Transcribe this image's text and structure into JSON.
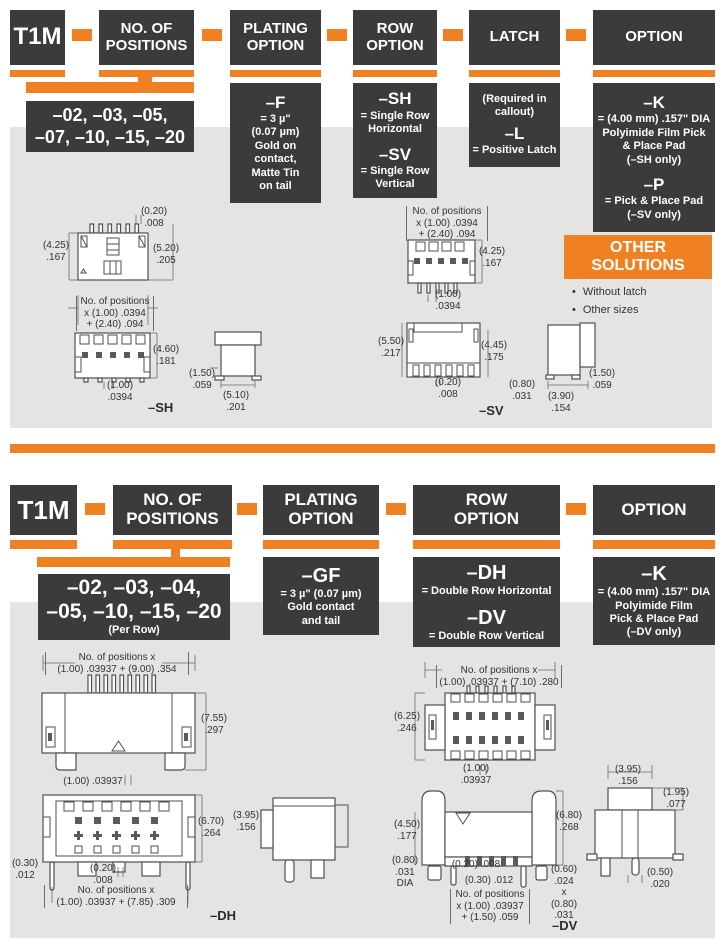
{
  "s1": {
    "code": "T1M",
    "headers": {
      "positions": "NO. OF\nPOSITIONS",
      "plating": "PLATING\nOPTION",
      "row": "ROW\nOPTION",
      "latch": "LATCH",
      "option": "OPTION"
    },
    "positions_values": "–02, –03, –05,\n–07, –10, –15, –20",
    "plating": {
      "code": "–F",
      "desc": "= 3 µ\"\n(0.07 µm)\nGold on\ncontact,\nMatte Tin\non tail"
    },
    "row": {
      "sh": {
        "code": "–SH",
        "desc": "= Single Row\nHorizontal"
      },
      "sv": {
        "code": "–SV",
        "desc": "= Single Row\nVertical"
      }
    },
    "latch": {
      "note": "(Required in\ncallout)",
      "code": "–L",
      "desc": "= Positive Latch"
    },
    "option": {
      "k": {
        "code": "–K",
        "desc": "= (4.00 mm) .157\" DIA\nPolyimide Film Pick\n& Place Pad\n(–SH only)"
      },
      "p": {
        "code": "–P",
        "desc": "= Pick & Place Pad\n(–SV only)"
      }
    },
    "other": {
      "title": "OTHER\nSOLUTIONS",
      "items": [
        "Without latch",
        "Other sizes"
      ]
    },
    "sh": {
      "note": "No. of positions\nx (1.00) .0394\n+ (2.40) .094",
      "d_pitch_top": "(0.20)\n.008",
      "d_h_left": "(4.25)\n.167",
      "d_h_right": "(5.20)\n.205",
      "d_front_h": "(4.60)\n.181",
      "d_front_pitch": "(1.00)\n.0394",
      "d_side_h": "(1.50)\n.059",
      "d_side_w": "(5.10)\n.201",
      "label": "–SH"
    },
    "sv": {
      "note": "No. of positions\nx (1.00) .0394\n+ (2.40) .094",
      "d_h_top": "(4.25)\n.167",
      "d_pitch": "(1.00)\n.0394",
      "d_h_left": "(5.50)\n.217",
      "d_h_right": "(4.45)\n.175",
      "d_pitch2": "(0.20)\n.008",
      "d_side_a": "(0.80)\n.031",
      "d_side_b": "(3.90)\n.154",
      "d_side_c": "(1.50)\n.059",
      "label": "–SV"
    }
  },
  "s2": {
    "code": "T1M",
    "headers": {
      "positions": "NO. OF\nPOSITIONS",
      "plating": "PLATING\nOPTION",
      "row": "ROW\nOPTION",
      "option": "OPTION"
    },
    "positions_values": "–02, –03, –04,\n–05, –10, –15, –20",
    "positions_note": "(Per Row)",
    "plating": {
      "code": "–GF",
      "desc": "= 3 µ\" (0.07 µm)\nGold contact\nand tail"
    },
    "row": {
      "dh": {
        "code": "–DH",
        "desc": "= Double Row Horizontal"
      },
      "dv": {
        "code": "–DV",
        "desc": "= Double Row Vertical"
      }
    },
    "option": {
      "k": {
        "code": "–K",
        "desc": "= (4.00 mm) .157\" DIA\nPolyimide Film\nPick & Place Pad\n(–DV only)"
      }
    },
    "dh": {
      "note_top": "No. of positions x\n(1.00) .03937 + (9.00) .354",
      "d_h1": "(7.55)\n.297",
      "d_pitch": "(1.00) .03937",
      "d_h2": "(6.70)\n.264",
      "d_side_w": "(3.95)\n.156",
      "d_tail": "(0.30)\n.012",
      "d_pin": "(0.20)\n.008",
      "note_bottom": "No. of positions x\n(1.00) .03937 + (7.85) .309",
      "label": "–DH"
    },
    "dv": {
      "note_top": "No. of positions x\n(1.00) .03937 + (7.10) .280",
      "d_h1": "(6.25)\n.246",
      "d_pitch": "(1.00)\n.03937",
      "d_h2": "(4.50)\n.177",
      "d_h3": "(6.80)\n.268",
      "d_dia": "(0.80)\n.031\nDIA",
      "d_pin": "(0.20) .008",
      "d_tail": "(0.30) .012",
      "note_bottom": "No. of positions\nx (1.00) .03937\n+ (1.50) .059",
      "d_pad": "(0.60)\n.024\nx\n(0.80)\n.031",
      "d_side_w": "(3.95)\n.156",
      "d_side_h": "(1.95)\n.077",
      "d_side_pin": "(0.50)\n.020",
      "label": "–DV"
    }
  }
}
